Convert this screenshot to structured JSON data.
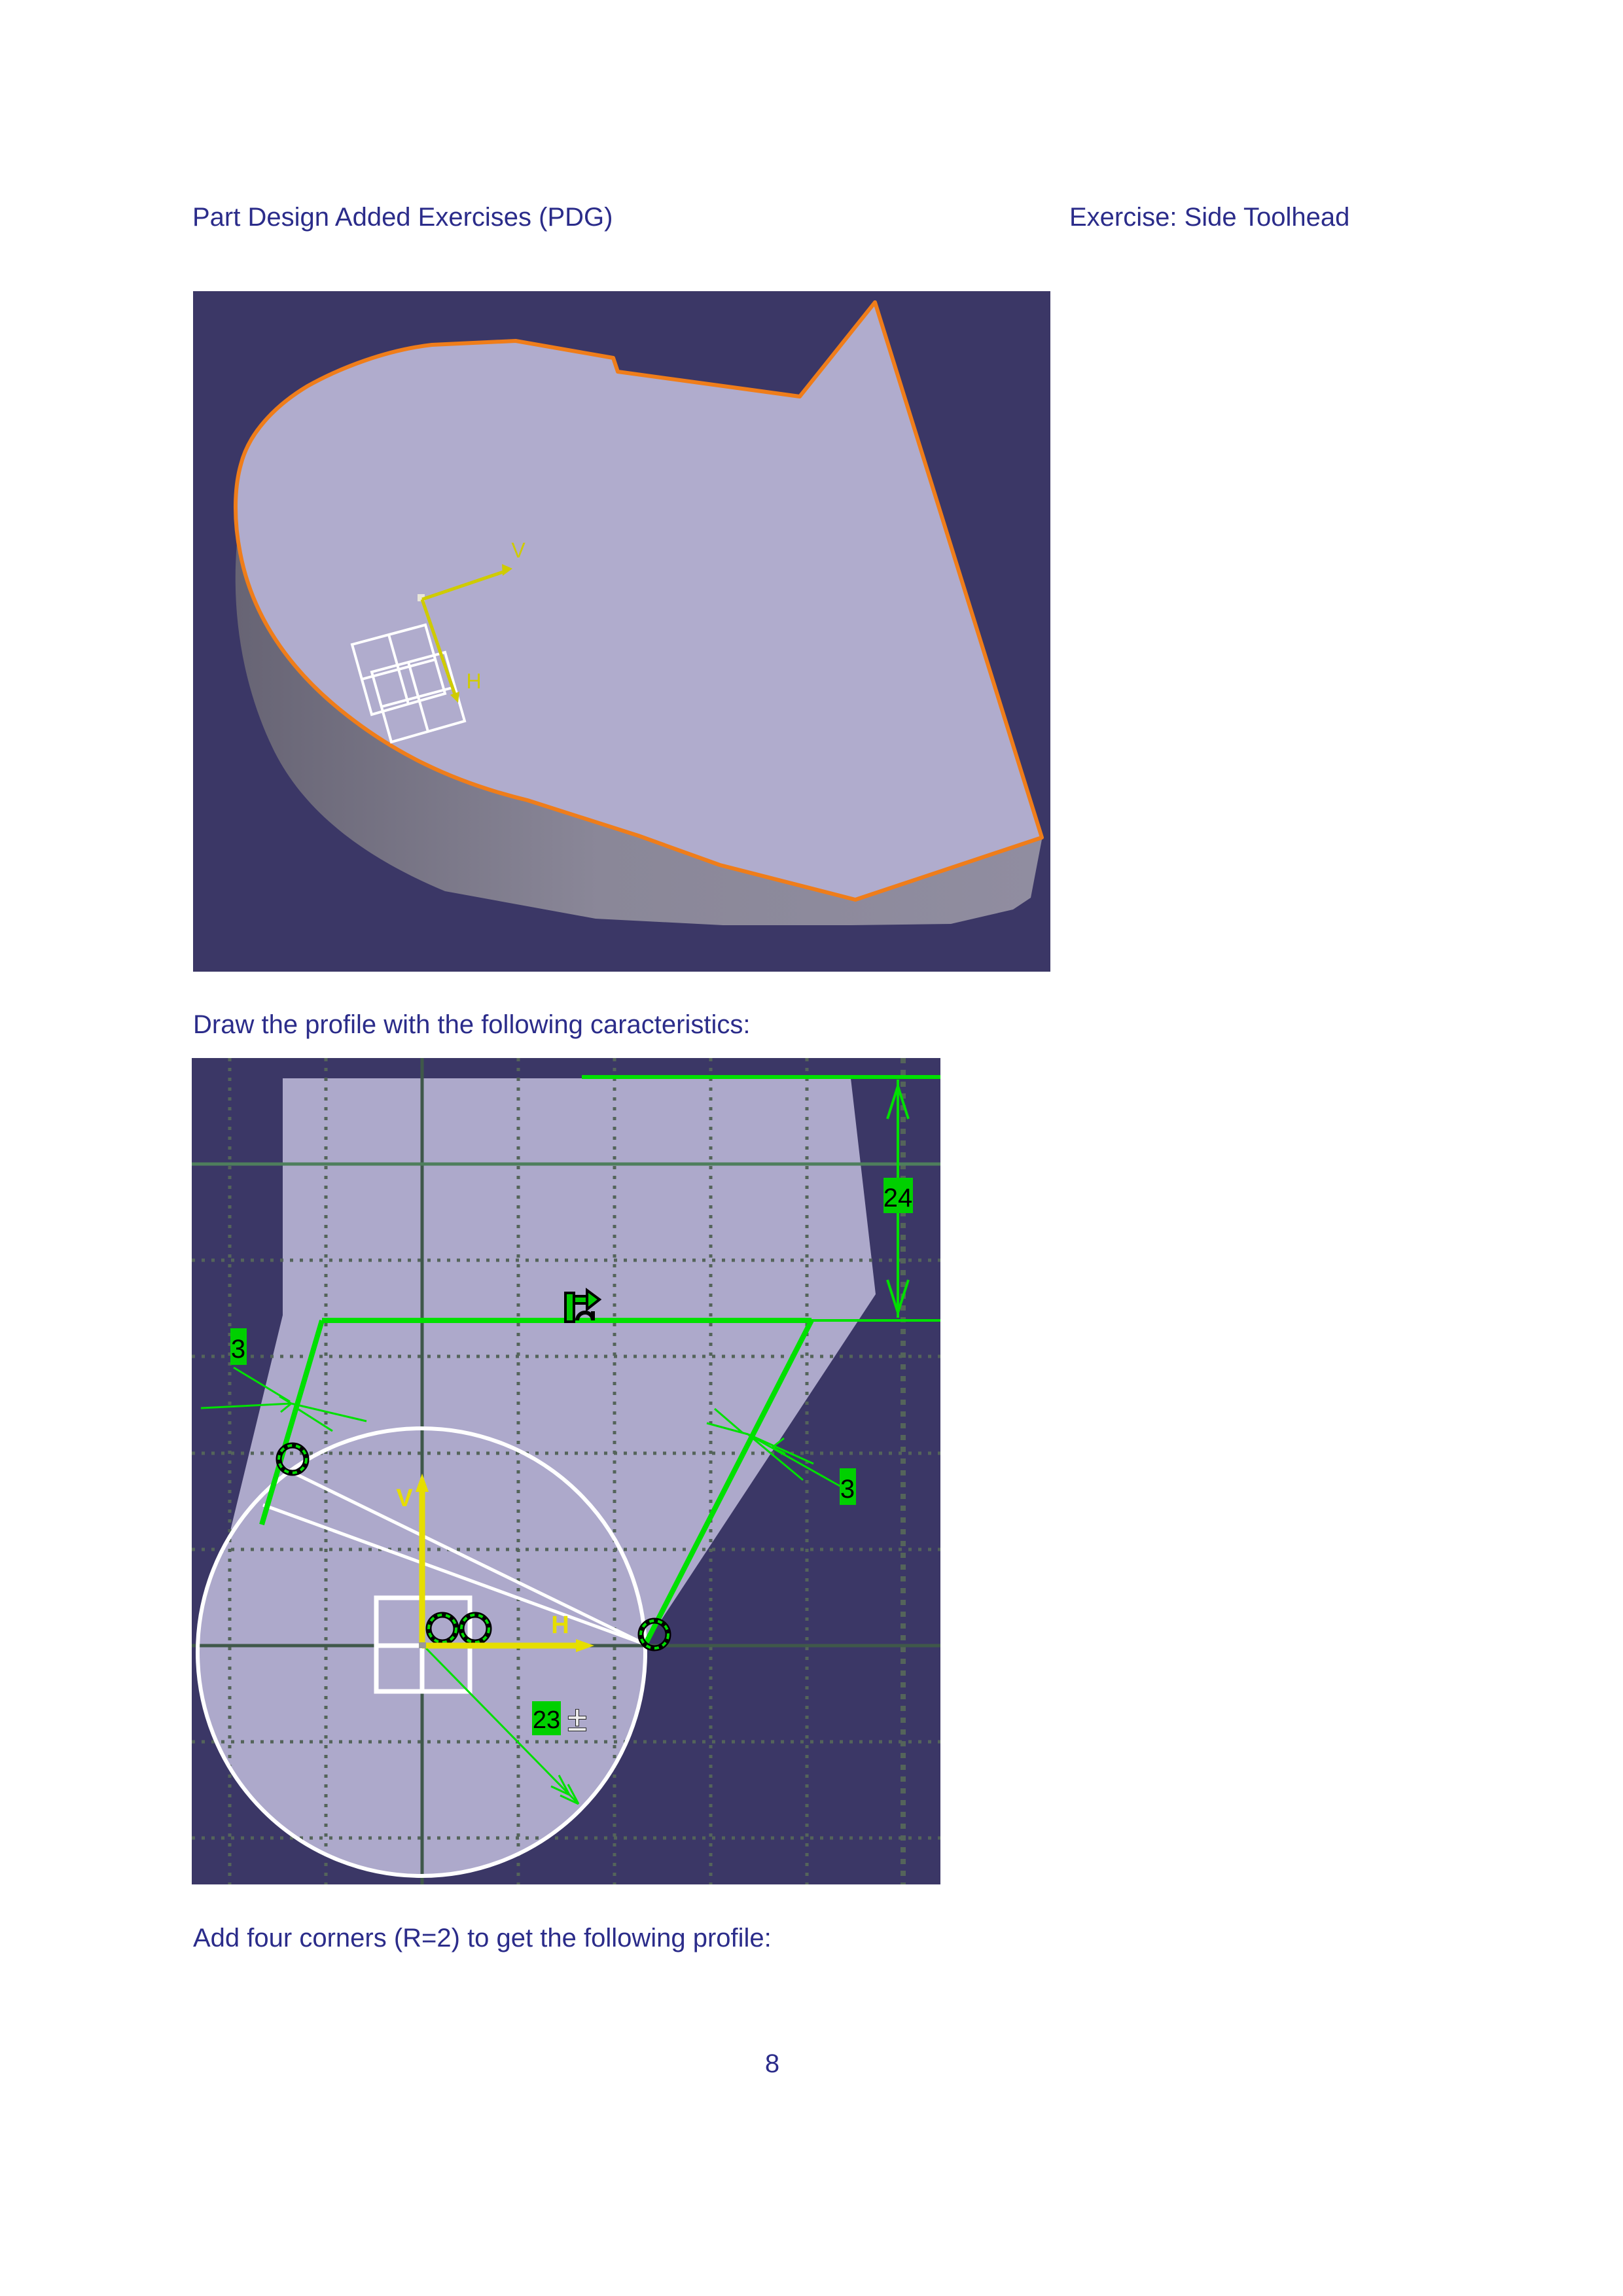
{
  "header": {
    "left": "Part Design Added Exercises (PDG)",
    "right": "Exercise: Side Toolhead"
  },
  "captions": {
    "draw_profile": "Draw the profile with the following caracteristics:",
    "add_corners": "Add four corners (R=2) to get the following profile:"
  },
  "page_number": "8",
  "viewer_3d": {
    "axis_v_label": "V",
    "axis_h_label": "H"
  },
  "sketch": {
    "axis_v_label": "V",
    "axis_h_label": "H",
    "dims": {
      "height": "24",
      "corner_left": "3",
      "corner_right": "3",
      "radius": "23",
      "tolerance_symbol": "±"
    }
  },
  "colors": {
    "viewport_background": "#3b3766",
    "part_top_face": "#ada9cb",
    "part_side_face": "#8a8798",
    "highlight_edge": "#ef7d1a",
    "sketch_green": "#00e000",
    "dimension_box": "#00d000",
    "construction_white": "#ffffff",
    "axis_yellow": "#e6de00",
    "grid_line": "#54645a",
    "document_text": "#2b2c8a"
  }
}
